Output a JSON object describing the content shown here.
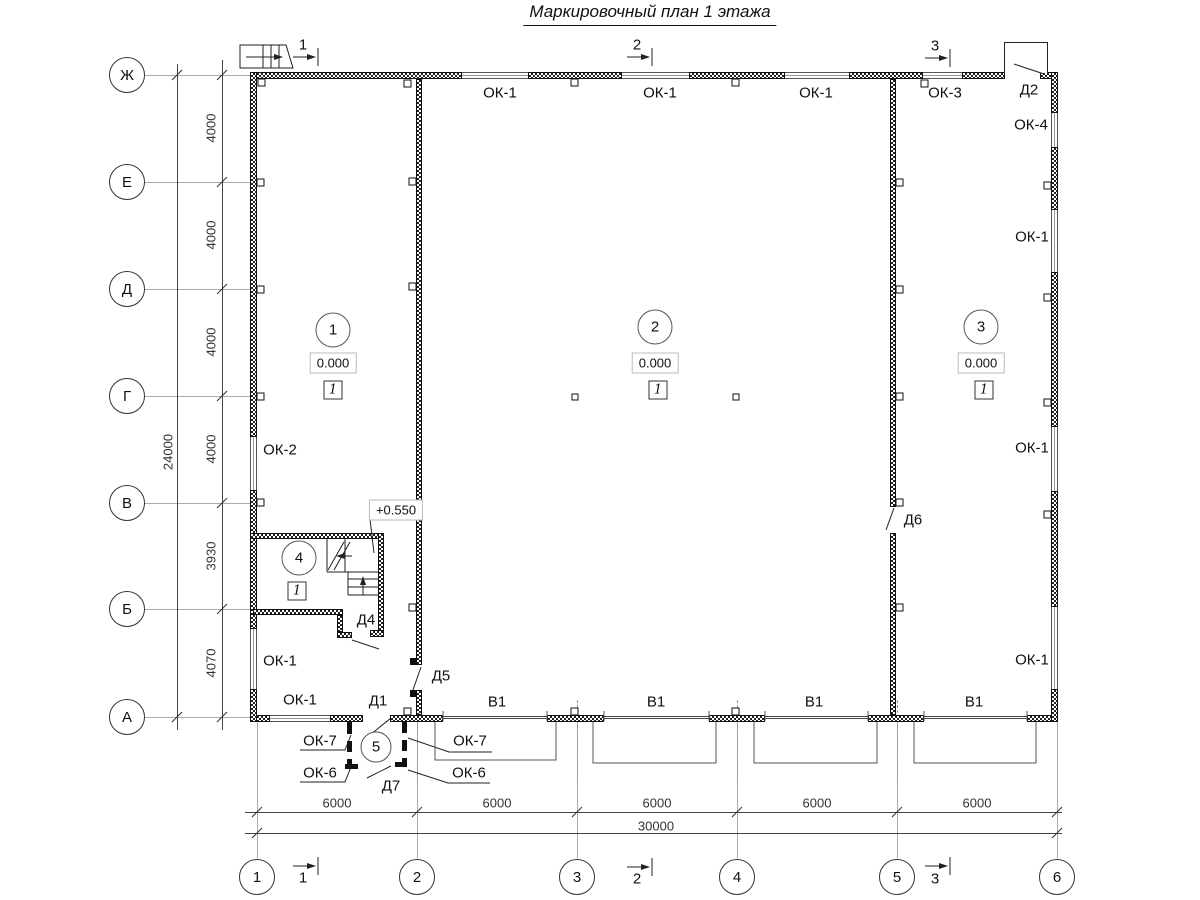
{
  "title": "Маркировочный план 1 этажа",
  "axes": {
    "rows": [
      "Ж",
      "Е",
      "Д",
      "Г",
      "В",
      "Б",
      "А"
    ],
    "cols": [
      "1",
      "2",
      "3",
      "4",
      "5",
      "6"
    ]
  },
  "dims": {
    "left_total": "24000",
    "left_segments": [
      "4000",
      "4000",
      "4000",
      "4000",
      "3930",
      "4070"
    ],
    "bottom_segments": [
      "6000",
      "6000",
      "6000",
      "6000",
      "6000"
    ],
    "bottom_total": "30000"
  },
  "sections": [
    "1",
    "2",
    "3"
  ],
  "rooms": {
    "r1": {
      "num": "1",
      "elev": "0.000",
      "floor": "1"
    },
    "r2": {
      "num": "2",
      "elev": "0.000",
      "floor": "1"
    },
    "r3": {
      "num": "3",
      "elev": "0.000",
      "floor": "1"
    },
    "r4": {
      "num": "4",
      "floor": "1"
    },
    "r5": {
      "num": "5"
    }
  },
  "stair": {
    "landing_elev": "+0.550"
  },
  "marks": {
    "ok1": "ОК-1",
    "ok2": "ОК-2",
    "ok3": "ОК-3",
    "ok4": "ОК-4",
    "ok6": "ОК-6",
    "ok7": "ОК-7",
    "d1": "Д1",
    "d2": "Д2",
    "d4": "Д4",
    "d5": "Д5",
    "d6": "Д6",
    "d7": "Д7",
    "v1": "В1"
  }
}
